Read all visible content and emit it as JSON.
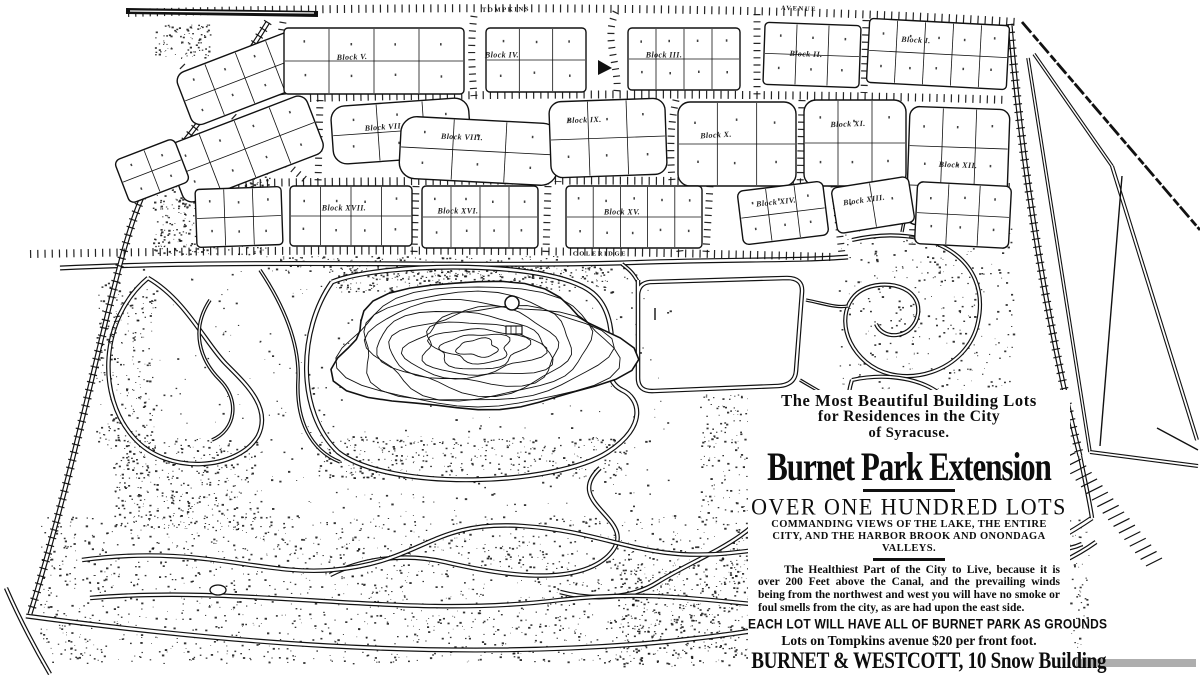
{
  "colors": {
    "ink": "#111111",
    "paper": "#ffffff"
  },
  "map": {
    "street_labels": [
      {
        "id": "tompkins",
        "text": "TOMPKINS",
        "x": 506,
        "y": 10,
        "rot": -1,
        "vertical": false
      },
      {
        "id": "avenue",
        "text": "AVENUE",
        "x": 799,
        "y": 9,
        "rot": 2,
        "vertical": false
      },
      {
        "id": "coleridge",
        "text": "COLERIDGE",
        "x": 600,
        "y": 254,
        "rot": 0,
        "vertical": false
      },
      {
        "id": "avery",
        "text": "AVERY",
        "x": 113,
        "y": 330,
        "rot": 16,
        "vertical": true
      }
    ],
    "block_labels": [
      {
        "id": "block-v",
        "text": "Block V.",
        "x": 352,
        "y": 57,
        "rot": -2
      },
      {
        "id": "block-iv",
        "text": "Block IV.",
        "x": 502,
        "y": 55,
        "rot": 0
      },
      {
        "id": "block-iii",
        "text": "Block III.",
        "x": 664,
        "y": 55,
        "rot": 0
      },
      {
        "id": "block-ii",
        "text": "Block II.",
        "x": 806,
        "y": 54,
        "rot": 2
      },
      {
        "id": "block-i",
        "text": "Block I.",
        "x": 916,
        "y": 40,
        "rot": 3
      },
      {
        "id": "block-vii",
        "text": "Block VII.",
        "x": 384,
        "y": 127,
        "rot": -4
      },
      {
        "id": "block-viii",
        "text": "Block VIII.",
        "x": 462,
        "y": 137,
        "rot": 2
      },
      {
        "id": "block-ix",
        "text": "Block IX.",
        "x": 584,
        "y": 120,
        "rot": -2
      },
      {
        "id": "block-x",
        "text": "Block X.",
        "x": 716,
        "y": 135,
        "rot": -3
      },
      {
        "id": "block-xi",
        "text": "Block XI.",
        "x": 848,
        "y": 124,
        "rot": -2
      },
      {
        "id": "block-xii",
        "text": "Block XII.",
        "x": 958,
        "y": 165,
        "rot": 2
      },
      {
        "id": "block-xvii",
        "text": "Block XVII.",
        "x": 344,
        "y": 208,
        "rot": 0
      },
      {
        "id": "block-xvi",
        "text": "Block XVI.",
        "x": 458,
        "y": 211,
        "rot": 0
      },
      {
        "id": "block-xv",
        "text": "Block XV.",
        "x": 622,
        "y": 212,
        "rot": 0
      },
      {
        "id": "block-xiv",
        "text": "Block XIV.",
        "x": 776,
        "y": 202,
        "rot": -6
      },
      {
        "id": "block-xiii",
        "text": "Block XIII.",
        "x": 864,
        "y": 200,
        "rot": -8
      }
    ]
  },
  "ad": {
    "tagline1": "The Most Beautiful Building Lots",
    "tagline2": "for Residences in the City",
    "tagline3": "of Syracuse.",
    "title": "Burnet Park Extension",
    "subtitle": "OVER ONE HUNDRED LOTS",
    "commanding": "COMMANDING VIEWS OF THE LAKE, THE ENTIRE CITY, AND THE HARBOR BROOK AND ONONDAGA VALLEYS.",
    "healthiest": "The Healthiest Part of the City to Live, because it is over 200 Feet above the Canal, and the prevailing winds being from the northwest and west you will have no smoke or foul smells from the city, as are had upon the east side.",
    "each_lot": "EACH LOT WILL HAVE ALL OF BURNET PARK AS GROUNDS",
    "price_line": "Lots on Tompkins avenue $20 per front foot.",
    "firm_line": "BURNET & WESTCOTT, 10 Snow Building",
    "offices": "Offices open from 7 to 9 o'clock Tuesday, Thursday and Saturday evenings."
  }
}
